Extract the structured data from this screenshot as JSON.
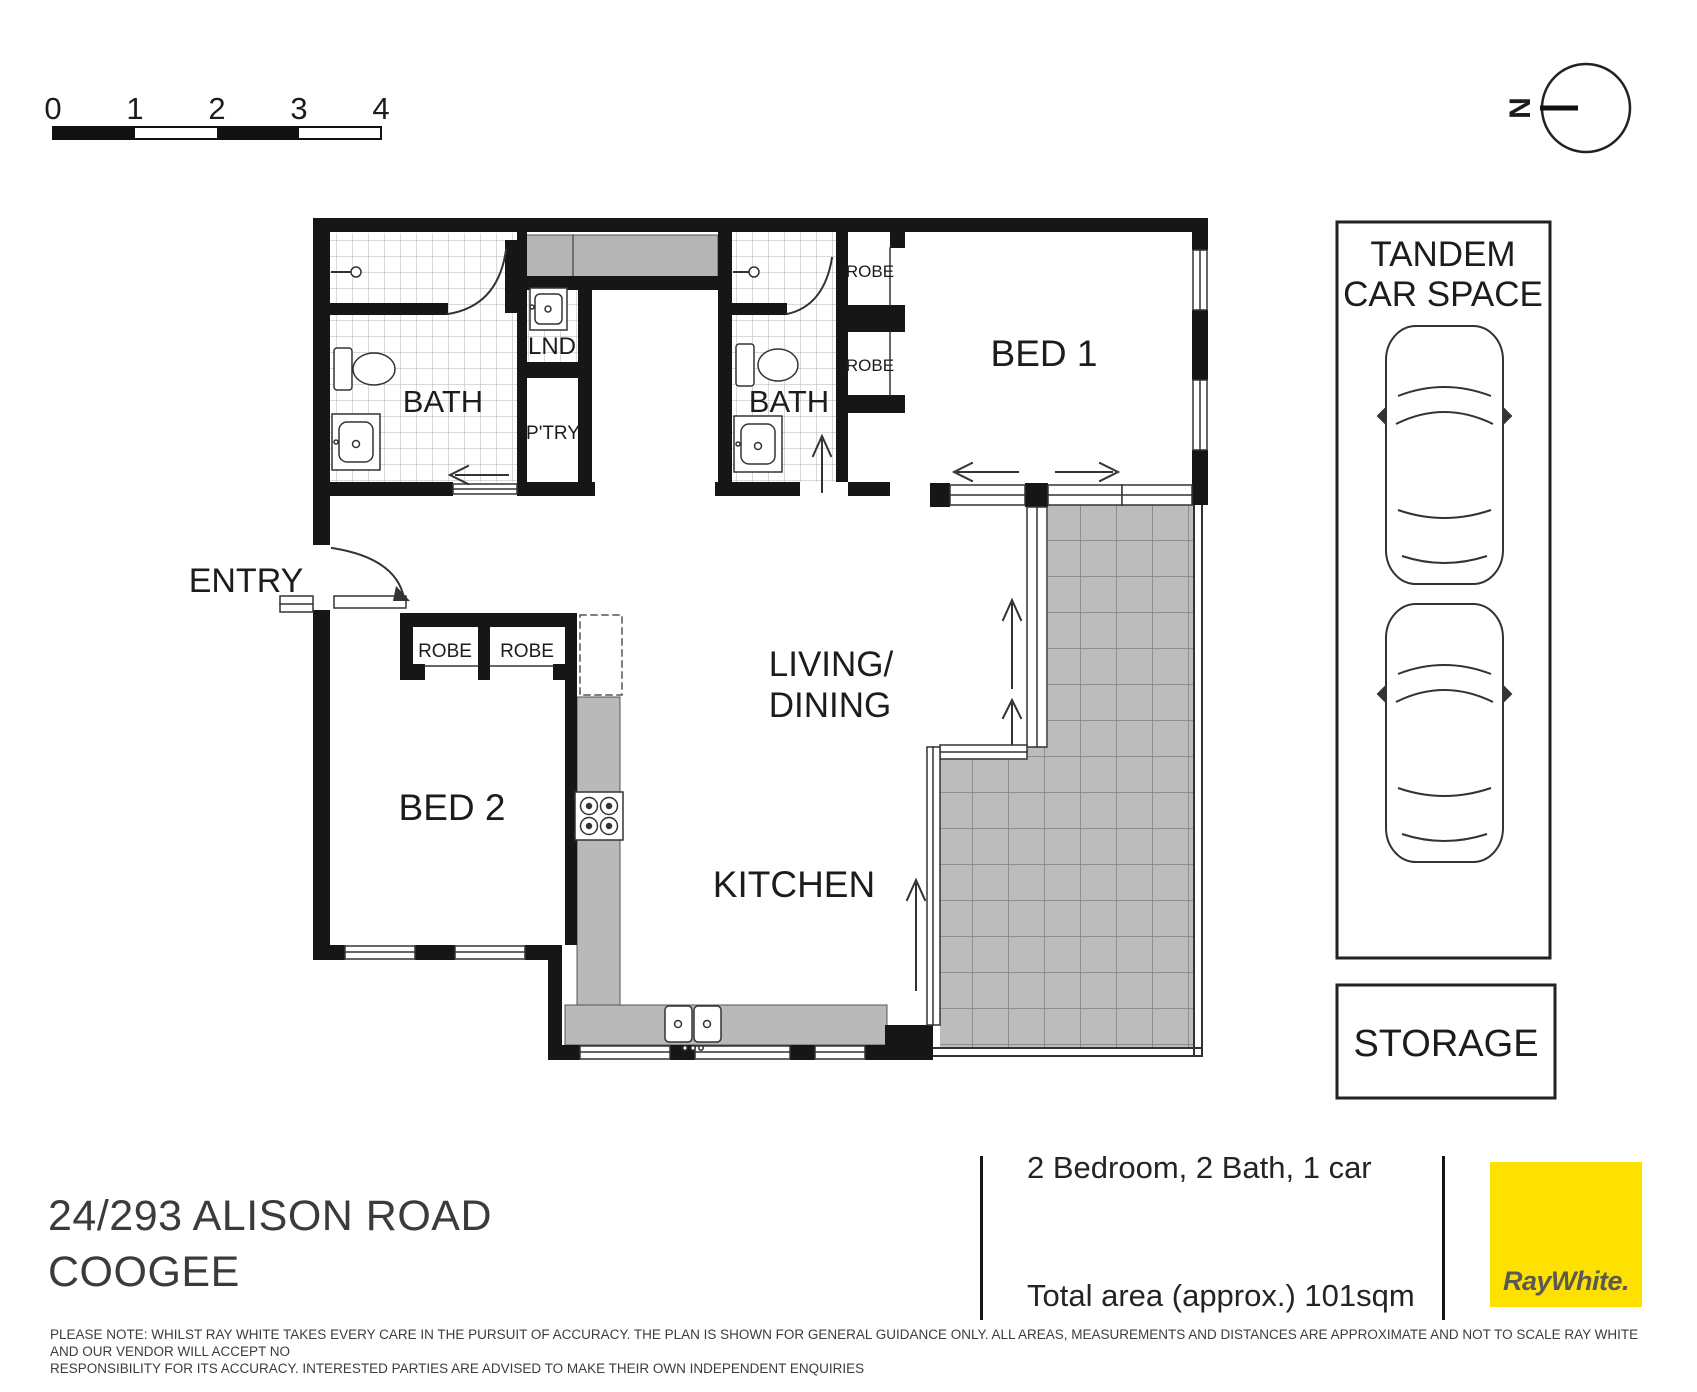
{
  "scale_bar": {
    "labels": [
      "0",
      "1",
      "2",
      "3",
      "4"
    ]
  },
  "compass": {
    "north_label": "N"
  },
  "rooms": {
    "bath1": "BATH",
    "laundry": "LND",
    "pantry": "P'TRY",
    "bath2": "BATH",
    "bed1_robe_top": "ROBE",
    "bed1_robe_bottom": "ROBE",
    "bed1": "BED 1",
    "entry": "ENTRY",
    "bed2_robe_left": "ROBE",
    "bed2_robe_right": "ROBE",
    "bed2": "BED 2",
    "living_line1": "LIVING/",
    "living_line2": "DINING",
    "kitchen": "KITCHEN"
  },
  "car_space": {
    "line1": "TANDEM",
    "line2": "CAR SPACE"
  },
  "storage": {
    "label": "STORAGE"
  },
  "footer": {
    "address_line1": "24/293 ALISON ROAD",
    "address_line2": "COOGEE",
    "summary": "2 Bedroom, 2 Bath, 1 car",
    "total_area": "Total area (approx.) 101sqm",
    "brand": "RayWhite.",
    "brand_color": "#ffe100",
    "disclaimer_line1": "PLEASE NOTE: WHILST RAY WHITE TAKES EVERY CARE IN THE PURSUIT OF ACCURACY. THE PLAN IS SHOWN FOR GENERAL GUIDANCE ONLY. ALL AREAS, MEASUREMENTS AND DISTANCES ARE APPROXIMATE AND NOT TO SCALE RAY WHITE AND OUR VENDOR WILL ACCEPT NO",
    "disclaimer_line2": "RESPONSIBILITY FOR ITS ACCURACY. INTERESTED PARTIES ARE ADVISED TO MAKE THEIR OWN INDEPENDENT ENQUIRIES"
  }
}
